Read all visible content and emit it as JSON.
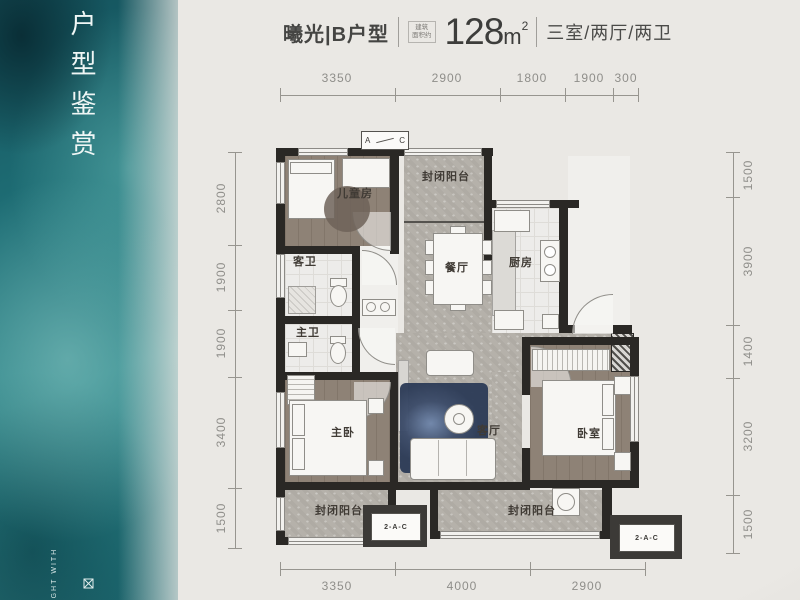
{
  "sidebar": {
    "vertical_title": "户型鉴赏",
    "footer_lines": [
      "WITH",
      "LIGHT"
    ],
    "teal_color": "#1f7077"
  },
  "header": {
    "plan_name": "曦光|B户型",
    "area_note_lines": [
      "建筑",
      "面积约"
    ],
    "area_value": "128",
    "area_unit_base": "m",
    "area_unit_sup": "2",
    "layout_text": "三室/两厅/两卫"
  },
  "dimensions": {
    "top": [
      "3350",
      "2900",
      "1800",
      "1900",
      "300"
    ],
    "bottom": [
      "3350",
      "4000",
      "2900"
    ],
    "left": [
      "2800",
      "1900",
      "1900",
      "3400",
      "1500"
    ],
    "right": [
      "1500",
      "3900",
      "1400",
      "3200",
      "1500"
    ]
  },
  "rooms": {
    "children": "儿童房",
    "balcony_top": "封闭阳台",
    "kitchen": "厨房",
    "dining": "餐厅",
    "guest_bath": "客卫",
    "master_bath": "主卫",
    "master_bed": "主卧",
    "living": "客厅",
    "bedroom2": "卧室",
    "balcony_bottom_left": "封闭阳台",
    "balcony_bottom_right": "封闭阳台"
  },
  "markers": {
    "top_left": "A",
    "top_right": "C",
    "bottom_center": "2-A-C",
    "bottom_right": "2-A-C"
  },
  "colors": {
    "wall": "#2a2825",
    "wood_floor": "#8e8276",
    "concrete_floor": "#b5b1aa",
    "rug_navy": "#2b3a56",
    "paper": "#eae8e4"
  }
}
